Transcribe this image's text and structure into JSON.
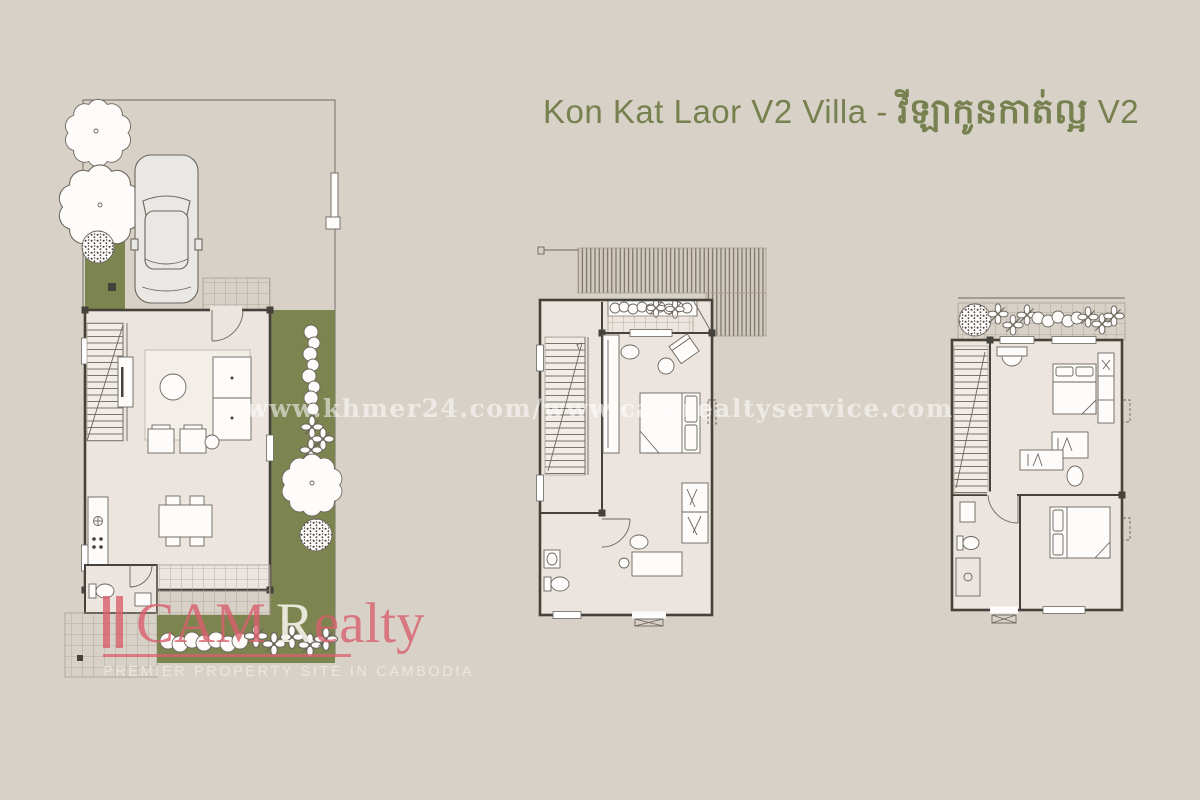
{
  "title": {
    "latin": "Kon Kat Laor V2 Villa - ",
    "khmer": "វីឡាកូនកាត់ល្អ",
    "suffix": " V2"
  },
  "watermark": "www.khmer24.com/www.camrealtyservice.com",
  "logo": {
    "name_part1": "CAM",
    "name_part2": "R",
    "name_part3": "ealty",
    "tagline": "PREMIER PROPERTY SITE IN CAMBODIA"
  },
  "colors": {
    "background": "#d8d1c7",
    "title_green": "#76814f",
    "floor_fill": "#ece5df",
    "garden_green": "#7c8450",
    "wall_line": "#45413b",
    "line_gray": "#6b665e",
    "tile_line": "#a89f92",
    "roof_line": "#6f685c",
    "hatch_bg": "#d2cabf",
    "logo_red": "#d95f6c",
    "logo_r_white": "#f4f0e8",
    "logo_tagline": "#f1ece2",
    "watermark_white": "#ffffff",
    "car_fill": "#e9e8e4",
    "drawing_white": "#fdfcfa"
  }
}
